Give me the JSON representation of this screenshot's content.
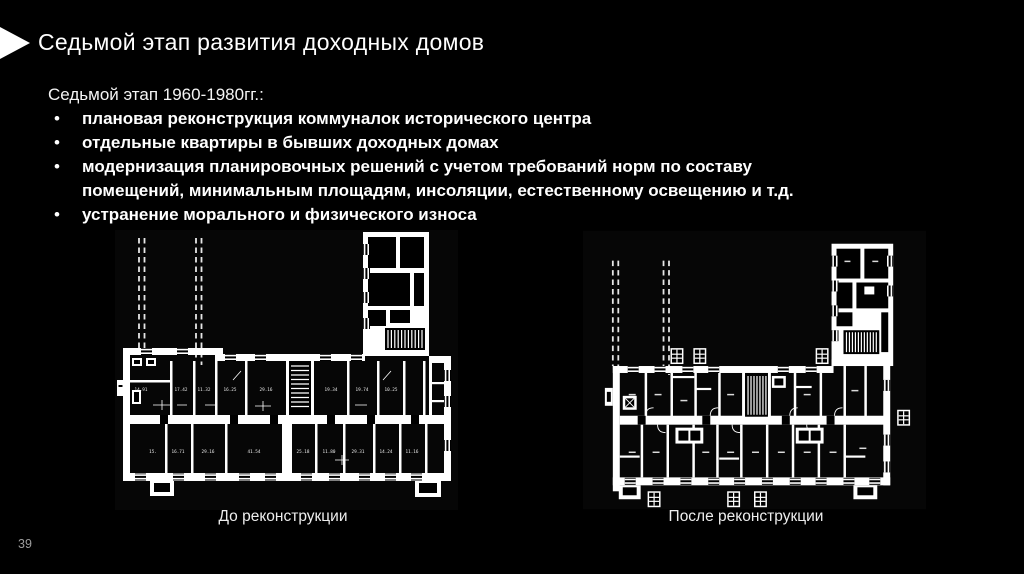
{
  "slide": {
    "title": "Седьмой этап развития доходных домов",
    "page_number": "39"
  },
  "body": {
    "heading": "Седьмой этап 1960-1980гг.:",
    "bullets": [
      "плановая реконструкция коммуналок исторического центра",
      "отдельные квартиры в бывших доходных домах",
      "модернизация планировочных решений с учетом требований норм по составу\nпомещений, минимальным площадям, инсоляции, естественному освещению и т.д.",
      "устранение морального и физического износа"
    ]
  },
  "figures": {
    "before": {
      "caption": "До реконструкции",
      "rooms_top": [
        "14.91",
        "17.42",
        "11.32",
        "16.25",
        "29.16",
        "19.34",
        "19.74",
        "10.25"
      ],
      "rooms_bottom": [
        "15.",
        "16.71",
        "29.16",
        "41.54",
        "25.18",
        "11.80",
        "29.31",
        "14.24",
        "11.16"
      ]
    },
    "after": {
      "caption": "После реконструкции"
    }
  },
  "colors": {
    "background": "#000000",
    "text": "#ffffff",
    "plan_ink": "#ffffff",
    "page_number": "#9d9d9d"
  }
}
